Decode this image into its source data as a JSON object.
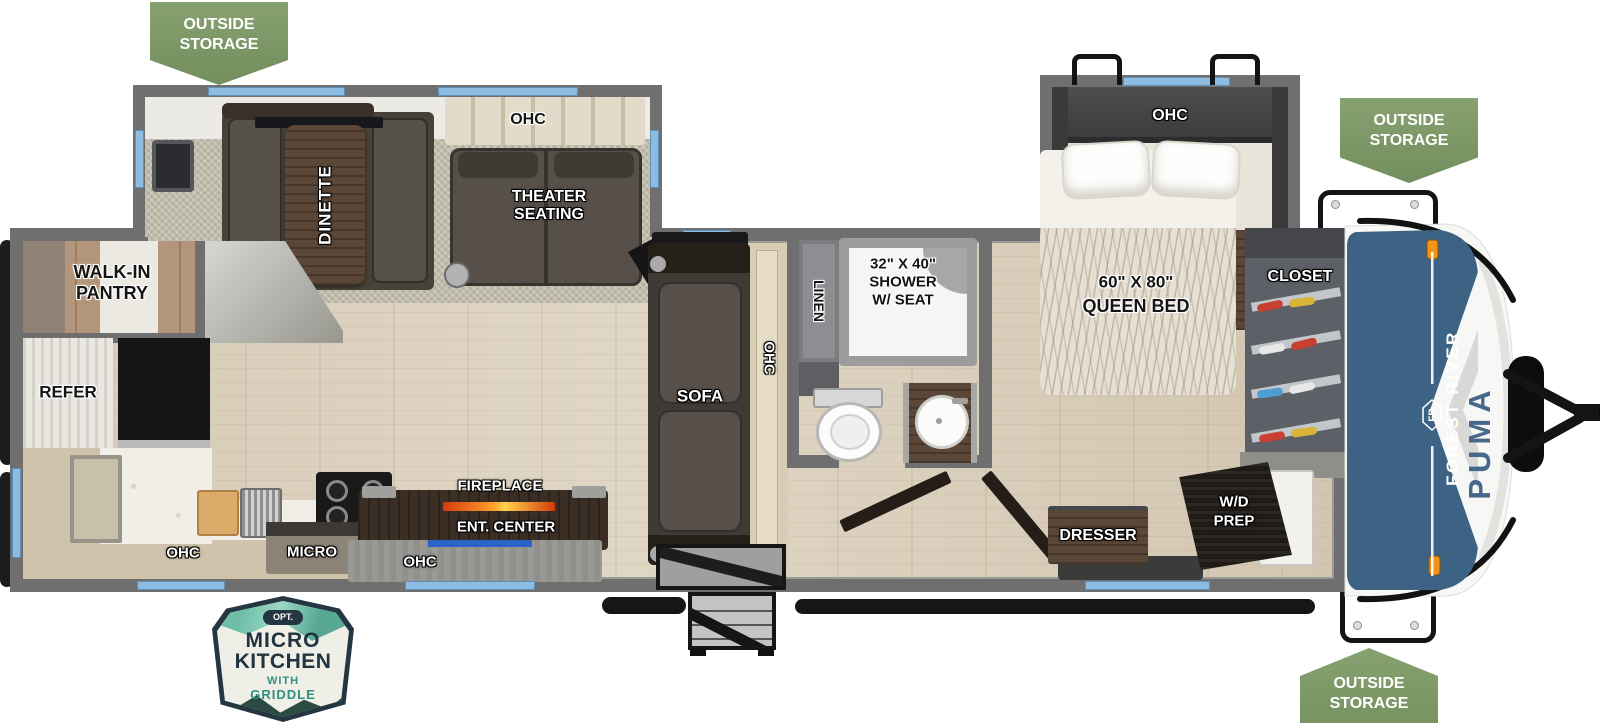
{
  "badges": {
    "outside_storage_top_left": {
      "line1": "OUTSIDE",
      "line2": "STORAGE"
    },
    "outside_storage_top_right": {
      "line1": "OUTSIDE",
      "line2": "STORAGE"
    },
    "outside_storage_bottom_right": {
      "line1": "OUTSIDE",
      "line2": "STORAGE"
    },
    "micro_kitchen": {
      "tag": "OPT.",
      "line1": "MICRO",
      "line2": "KITCHEN",
      "line3": "WITH",
      "line4": "GRIDDLE"
    }
  },
  "branding": {
    "make": "FOREST RIVER",
    "model": "PUMA",
    "logo": "FR"
  },
  "labels": {
    "pantry1": "WALK-IN",
    "pantry2": "PANTRY",
    "refer": "REFER",
    "kitchen_ohc": "OHC",
    "micro": "MICRO",
    "dinette": "DINETTE",
    "theater_ohc": "OHC",
    "theater1": "THEATER",
    "theater2": "SEATING",
    "fireplace": "FIREPLACE",
    "ent_center": "ENT. CENTER",
    "ent_ohc": "OHC",
    "sofa": "SOFA",
    "sofa_ohc": "OHC",
    "linen": "LINEN",
    "shower1": "32\" X 40\"",
    "shower2": "SHOWER",
    "shower3": "W/ SEAT",
    "bedroom_ohc": "OHC",
    "bed1": "60\" X 80\"",
    "bed2": "QUEEN BED",
    "closet": "CLOSET",
    "dresser": "DRESSER",
    "wd1": "W/D",
    "wd2": "PREP"
  },
  "colors": {
    "badge_green": "#7d9767",
    "wall_gray": "#6f6f6f",
    "window_blue": "#8cbce2",
    "cap_blue": "#3d6384",
    "puma_text_blue": "#46688a",
    "fireplace_orange": "#f0941a",
    "floor_wood": "#d8cdbb",
    "carpet": "#c0bbaa"
  }
}
